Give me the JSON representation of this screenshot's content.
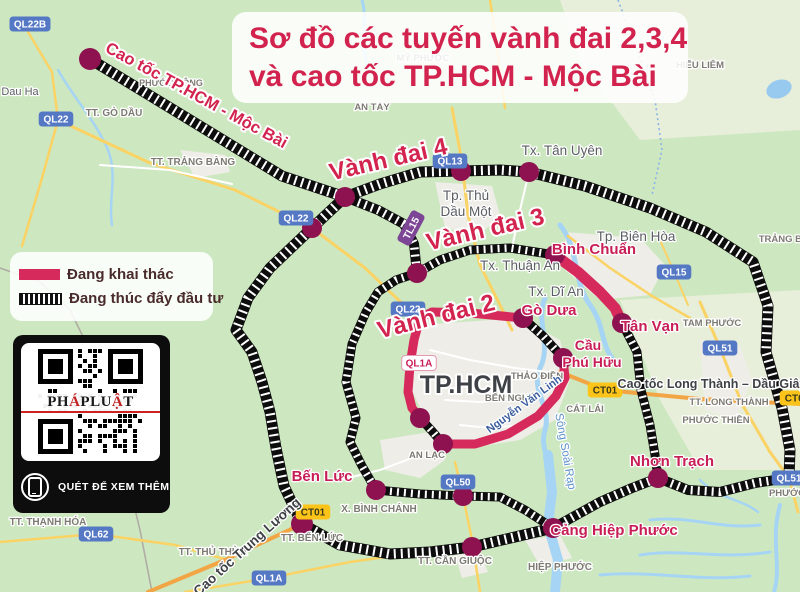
{
  "title": {
    "line1": "Sơ đồ các tuyến vành đai 2,3,4",
    "line2": "và cao tốc TP.HCM - Mộc Bài"
  },
  "legend": {
    "items": [
      {
        "label": "Đang khai thác",
        "type": "solid"
      },
      {
        "label": "Đang thúc đẩy đầu tư",
        "type": "striped"
      }
    ]
  },
  "qr": {
    "brand_parts": [
      {
        "t": "PH",
        "c": "#1a1a1a"
      },
      {
        "t": "Á",
        "c": "#c22222"
      },
      {
        "t": "PLU",
        "c": "#1a1a1a"
      },
      {
        "t": "Ậ",
        "c": "#c22222"
      },
      {
        "t": "T",
        "c": "#1a1a1a"
      }
    ],
    "caption": "QUÉT ĐỂ XEM THÊM"
  },
  "map": {
    "colors": {
      "bg": "#cde8c0",
      "urban": "#eeede7",
      "pale": "#e7eeda",
      "water": "#98c9ef",
      "river": "#a6d4f4",
      "road_yellow": "#fbd264",
      "road_orange": "#f2a544",
      "road_white": "#ffffff",
      "dash_black": "#0d0d0d",
      "pink_route": "#d62a5c",
      "dot": "#8e1150",
      "shield_blue": "#5578c4",
      "shield_yellow": "#fcc419",
      "shield_purple": "#7d4596",
      "gray": "#7c7a72",
      "city": "#5b5e63",
      "dark": "#3e4145",
      "pinklabel": "#c81e56",
      "bigpink": "#d2244e",
      "waterlabel": "#5e92cc",
      "roadblue": "#3d5e9e",
      "boundary": "#b0aca4",
      "boundary_blue": "#8ab4e8"
    },
    "urban": [
      {
        "d": "M420,325 L520,318 L560,340 L570,380 L555,420 L520,440 L470,448 L430,430 L412,390 L410,350 Z"
      },
      {
        "d": "M565,232 L640,238 L665,265 L650,295 L600,300 L565,270 Z"
      },
      {
        "d": "M435,182 L492,186 L500,215 L480,235 L445,228 Z"
      },
      {
        "d": "M380,440 L430,432 L445,460 L420,478 L385,470 Z"
      },
      {
        "d": "M700,340 L740,345 L752,380 L735,420 L705,410 Z"
      },
      {
        "d": "M180,150 L225,155 L230,172 L195,178 Z"
      },
      {
        "d": "M455,555 L480,552 L488,572 L462,578 Z"
      },
      {
        "d": "M525,540 L560,535 L572,558 L540,566 Z"
      }
    ],
    "pale": [
      {
        "d": "M560,0 L800,0 L800,130 L640,140 L580,60 Z"
      },
      {
        "d": "M620,300 L800,290 L800,470 L700,470 L660,400 Z"
      }
    ],
    "boundaries": [
      {
        "d": "M0,268 L40,282 L70,310 L92,355 L112,420 L128,480 L140,530 L152,592",
        "style": "land"
      },
      {
        "d": "M618,0 L636,48 L655,100 L662,150 L652,195",
        "style": "admin"
      }
    ],
    "water_paths": [
      {
        "d": "M545,298 C535,320 552,345 540,368 C530,390 552,408 545,430 C538,452 558,470 552,492",
        "w": 5
      },
      {
        "d": "M560,225 C580,250 572,280 590,305 C605,325 600,345 615,362",
        "w": 5
      },
      {
        "d": "M548,455 L552,492 L548,525 L558,560 L555,592",
        "w": 10
      },
      {
        "d": "M650,520 C690,515 720,530 760,525",
        "w": 3
      },
      {
        "d": "M640,555 C680,548 720,560 770,552",
        "w": 3
      },
      {
        "d": "M600,575 C650,570 700,582 750,576",
        "w": 3
      },
      {
        "d": "M58,70 C75,100 95,120 108,150 C118,175 108,200 112,225",
        "w": 2.5
      },
      {
        "d": "M362,0 C368,20 360,45 368,70",
        "w": 3
      },
      {
        "d": "M780,505 C770,540 782,565 774,592",
        "w": 4
      },
      {
        "d": "M700,480 C720,500 740,498 758,512",
        "w": 2.5
      }
    ],
    "lake": {
      "cx": 779,
      "cy": 89,
      "rx": 13,
      "ry": 9,
      "rot": -20
    },
    "roads": [
      {
        "d": "M58,120 L150,163 L235,190 L312,228 L365,268 L408,309 L418,322",
        "c": "road_yellow",
        "w": 3
      },
      {
        "d": "M28,32 L52,72 L58,120 L42,178 L22,246",
        "c": "road_yellow",
        "w": 2.5
      },
      {
        "d": "M452,108 L462,162 L468,215 L480,265 L500,305 L512,330",
        "c": "road_yellow",
        "w": 3
      },
      {
        "d": "M700,302 L720,348 L742,404 L770,452 L789,478 L798,512",
        "c": "road_yellow",
        "w": 3
      },
      {
        "d": "M185,592 L269,578 L350,562 L420,552",
        "c": "road_yellow",
        "w": 2.5
      },
      {
        "d": "M455,462 L463,496 L472,540 L480,592",
        "c": "road_yellow",
        "w": 2.5
      },
      {
        "d": "M0,542 L96,534 L175,545 L235,562",
        "c": "road_yellow",
        "w": 2.5
      },
      {
        "d": "M568,236 L610,268 L652,296 L690,318",
        "c": "road_yellow",
        "w": 2.5
      },
      {
        "d": "M660,240 L674,272 L688,305",
        "c": "road_yellow",
        "w": 2
      },
      {
        "d": "M490,0 L498,55 L505,108",
        "c": "road_yellow",
        "w": 2.5
      },
      {
        "d": "M560,372 L605,390 L700,399 L800,404",
        "c": "road_orange",
        "w": 4
      },
      {
        "d": "M148,592 L225,560 L302,524",
        "c": "road_orange",
        "w": 4
      },
      {
        "d": "M430,350 L470,360 L515,368 L548,372",
        "c": "road_white",
        "w": 2
      },
      {
        "d": "M445,400 L480,402 L515,398",
        "c": "road_white",
        "w": 2
      },
      {
        "d": "M460,425 L490,428 L520,425",
        "c": "road_white",
        "w": 2
      },
      {
        "d": "M340,480 L380,470 L420,455",
        "c": "road_white",
        "w": 2
      },
      {
        "d": "M529,172 L520,210 L512,248",
        "c": "road_white",
        "w": 2
      },
      {
        "d": "M100,165 L170,170 L232,184",
        "c": "road_white",
        "w": 2
      }
    ],
    "routes_dashed": [
      {
        "name": "cao-toc-moc-bai",
        "d": "M90,59 L282,176 L345,197",
        "w": 11
      },
      {
        "name": "vanh-dai-4-west",
        "d": "M345,197 L312,228 L270,268 L248,298 L236,330 L252,352 L262,382 L270,412 L276,448 L284,486 L302,524",
        "w": 11
      },
      {
        "name": "vanh-dai-4-north-east",
        "d": "M345,197 L380,184 L420,172 L461,171 L500,170 L529,172 L585,186 L650,208 L706,232 L753,262 L768,306 L766,352 L782,408 L790,450 L789,478",
        "w": 11
      },
      {
        "name": "vanh-dai-4-south",
        "d": "M302,524 L340,545 L390,554 L430,552 L472,547 L515,537 L553,528",
        "w": 11
      },
      {
        "name": "hiep-phuoc-nhon-trach",
        "d": "M553,528 L600,502 L632,488 L658,478",
        "w": 10
      },
      {
        "name": "nhon-trach-ql51",
        "d": "M658,478 L688,490 L720,492 L755,483 L789,478",
        "w": 10
      },
      {
        "name": "moc-bai-noi-dai",
        "d": "M345,197 L378,210 L404,224 L414,244 L417,273",
        "w": 10
      },
      {
        "name": "vanh-dai-3-west",
        "d": "M417,273 L396,280 L378,292 L366,312 L352,344 L346,382 L356,418 L350,442 L362,466 L376,490",
        "w": 9
      },
      {
        "name": "vanh-dai-3-northwest",
        "d": "M555,255 L510,248 L470,250 L440,260 L417,273",
        "w": 9
      },
      {
        "name": "vanh-dai-3-south",
        "d": "M376,490 L420,494 L463,496 L500,497 L525,510 L553,528",
        "w": 9
      },
      {
        "name": "vanh-dai-3-east",
        "d": "M622,323 L637,352 L641,390 L650,425 L655,455 L658,478",
        "w": 9
      },
      {
        "name": "vanh-dai-2-gap-go-dua",
        "d": "M523,318 L543,336 L563,358",
        "w": 9
      },
      {
        "name": "vanh-dai-2-gap-an-lac",
        "d": "M420,418 L432,431 L443,444",
        "w": 9
      }
    ],
    "routes_pink": [
      {
        "name": "vanh-dai-2-top",
        "d": "M420,318 L432,312 L470,313 L523,318",
        "w": 9
      },
      {
        "name": "vanh-dai-2-west",
        "d": "M420,318 L414,340 L410,365 L408,392 L412,408 L420,418",
        "w": 9
      },
      {
        "name": "vanh-dai-2-nguyen-van-linh",
        "d": "M443,444 L475,444 L508,434 L538,416 L556,396 L565,378 L563,358",
        "w": 9
      },
      {
        "name": "binh-chuan-tan-van",
        "d": "M555,255 L578,272 L600,292 L615,308 L622,323",
        "w": 11
      }
    ],
    "dots": [
      {
        "x": 90,
        "y": 59,
        "r": 11
      },
      {
        "x": 345,
        "y": 197,
        "r": 10
      },
      {
        "x": 312,
        "y": 228,
        "r": 10
      },
      {
        "x": 461,
        "y": 171,
        "r": 10
      },
      {
        "x": 529,
        "y": 172,
        "r": 10
      },
      {
        "x": 417,
        "y": 273,
        "r": 10
      },
      {
        "x": 555,
        "y": 255,
        "r": 10
      },
      {
        "x": 523,
        "y": 318,
        "r": 10
      },
      {
        "x": 622,
        "y": 323,
        "r": 10
      },
      {
        "x": 563,
        "y": 358,
        "r": 10
      },
      {
        "x": 420,
        "y": 418,
        "r": 10
      },
      {
        "x": 443,
        "y": 444,
        "r": 10
      },
      {
        "x": 376,
        "y": 490,
        "r": 10
      },
      {
        "x": 463,
        "y": 496,
        "r": 10
      },
      {
        "x": 302,
        "y": 524,
        "r": 11
      },
      {
        "x": 472,
        "y": 547,
        "r": 10
      },
      {
        "x": 553,
        "y": 528,
        "r": 10
      },
      {
        "x": 658,
        "y": 478,
        "r": 10
      }
    ],
    "shields": [
      {
        "text": "QL22B",
        "x": 30,
        "y": 24,
        "type": "blue"
      },
      {
        "text": "QL22",
        "x": 56,
        "y": 119,
        "type": "blue"
      },
      {
        "text": "QL22",
        "x": 296,
        "y": 218,
        "type": "blue"
      },
      {
        "text": "QL22",
        "x": 408,
        "y": 309,
        "type": "blue"
      },
      {
        "text": "QL13",
        "x": 450,
        "y": 161,
        "type": "blue"
      },
      {
        "text": "QL15",
        "x": 674,
        "y": 272,
        "type": "blue"
      },
      {
        "text": "QL51",
        "x": 720,
        "y": 348,
        "type": "blue"
      },
      {
        "text": "QL51",
        "x": 789,
        "y": 478,
        "type": "blue"
      },
      {
        "text": "QL50",
        "x": 458,
        "y": 482,
        "type": "blue"
      },
      {
        "text": "QL62",
        "x": 96,
        "y": 534,
        "type": "blue"
      },
      {
        "text": "QL1A",
        "x": 269,
        "y": 578,
        "type": "blue"
      },
      {
        "text": "QL1A",
        "x": 419,
        "y": 363,
        "type": "whitepink"
      },
      {
        "text": "CT01",
        "x": 313,
        "y": 512,
        "type": "yellow"
      },
      {
        "text": "CT01",
        "x": 605,
        "y": 390,
        "type": "yellow"
      },
      {
        "text": "CT01",
        "x": 797,
        "y": 398,
        "type": "yellow"
      },
      {
        "text": "TL15",
        "x": 411,
        "y": 228,
        "type": "purple",
        "rot": -62
      }
    ],
    "labels": [
      {
        "text": "Dau Ha",
        "x": 20,
        "y": 95,
        "s": 11,
        "c": "city",
        "w": 400
      },
      {
        "text": "PHƯỚC ĐÔNG",
        "x": 171,
        "y": 86,
        "s": 9,
        "c": "gray",
        "w": 700
      },
      {
        "text": "TT. TRẢNG BÀNG",
        "x": 193,
        "y": 165,
        "s": 10,
        "c": "gray",
        "w": 700
      },
      {
        "text": "TT. GÒ DẦU",
        "x": 114,
        "y": 116,
        "s": 10,
        "c": "gray",
        "w": 700
      },
      {
        "text": "AN TÂY",
        "x": 372,
        "y": 110,
        "s": 9.5,
        "c": "gray",
        "w": 700
      },
      {
        "text": "MỸ PHƯỚC",
        "x": 423,
        "y": 61,
        "s": 9.5,
        "c": "gray",
        "w": 700
      },
      {
        "text": "Tp. Thủ",
        "x": 466,
        "y": 200,
        "s": 13.5,
        "c": "city",
        "w": 400
      },
      {
        "text": "Dầu Một",
        "x": 466,
        "y": 216,
        "s": 13.5,
        "c": "city",
        "w": 400
      },
      {
        "text": "Tx. Tân Uyên",
        "x": 562,
        "y": 155,
        "s": 13.5,
        "c": "city",
        "w": 400
      },
      {
        "text": "HIẾU LIÊM",
        "x": 700,
        "y": 68,
        "s": 9.5,
        "c": "gray",
        "w": 700
      },
      {
        "text": "Tp. Biên Hòa",
        "x": 636,
        "y": 241,
        "s": 13.5,
        "c": "city",
        "w": 400
      },
      {
        "text": "TRẢNG BOM",
        "x": 788,
        "y": 242,
        "s": 9.5,
        "c": "gray",
        "w": 700
      },
      {
        "text": "Tx. Thuận An",
        "x": 520,
        "y": 270,
        "s": 13.5,
        "c": "city",
        "w": 400
      },
      {
        "text": "Tx. Dĩ An",
        "x": 556,
        "y": 296,
        "s": 13.5,
        "c": "city",
        "w": 400
      },
      {
        "text": "TAM PHƯỚC",
        "x": 712,
        "y": 326,
        "s": 9.5,
        "c": "gray",
        "w": 700
      },
      {
        "text": "Cao tốc Long Thành – Dầu Giây",
        "x": 712,
        "y": 388,
        "s": 12.5,
        "c": "dark",
        "w": 700
      },
      {
        "text": "TT. LONG THÀNH",
        "x": 729,
        "y": 405,
        "s": 9.5,
        "c": "gray",
        "w": 700
      },
      {
        "text": "PHƯỚC THIỀN",
        "x": 716,
        "y": 423,
        "s": 9.5,
        "c": "gray",
        "w": 700
      },
      {
        "text": "PHƯỚC AN",
        "x": 795,
        "y": 496,
        "s": 9.5,
        "c": "gray",
        "w": 700
      },
      {
        "text": "TP.HCM",
        "x": 466,
        "y": 393,
        "s": 25,
        "c": "dark",
        "w": 800
      },
      {
        "text": "THẢO ĐIỀN",
        "x": 537,
        "y": 379,
        "s": 9.5,
        "c": "gray",
        "w": 700
      },
      {
        "text": "BẾN NGHÉ",
        "x": 510,
        "y": 401,
        "s": 9.5,
        "c": "gray",
        "w": 700
      },
      {
        "text": "CÁT LÁI",
        "x": 585,
        "y": 412,
        "s": 9.5,
        "c": "gray",
        "w": 700
      },
      {
        "text": "AN LẠC",
        "x": 427,
        "y": 458,
        "s": 9.5,
        "c": "gray",
        "w": 700
      },
      {
        "text": "X. BÌNH CHÁNH",
        "x": 379,
        "y": 512,
        "s": 10,
        "c": "gray",
        "w": 700
      },
      {
        "text": "TT. BẾN LỨC",
        "x": 312,
        "y": 541,
        "s": 10,
        "c": "gray",
        "w": 700
      },
      {
        "text": "TT. THẠNH HÓA",
        "x": 48,
        "y": 525,
        "s": 10,
        "c": "gray",
        "w": 700
      },
      {
        "text": "TT. THỦ THỪA",
        "x": 213,
        "y": 555,
        "s": 10,
        "c": "gray",
        "w": 700
      },
      {
        "text": "TT. CẦN GIUỘC",
        "x": 455,
        "y": 564,
        "s": 10,
        "c": "gray",
        "w": 700
      },
      {
        "text": "HIỆP PHƯỚC",
        "x": 560,
        "y": 570,
        "s": 10,
        "c": "gray",
        "w": 700
      },
      {
        "text": "Sông Soài Rạp",
        "x": 562,
        "y": 452,
        "s": 11.5,
        "c": "waterlabel",
        "w": 400,
        "rot": 80
      },
      {
        "text": "Nguyễn Văn Linh",
        "x": 526,
        "y": 407,
        "s": 11,
        "c": "roadblue",
        "w": 700,
        "rot": -36
      },
      {
        "text": "Cao tốc Trung Lương",
        "x": 250,
        "y": 550,
        "s": 13.5,
        "c": "dark",
        "w": 700,
        "rot": -42
      },
      {
        "text": "Bình Chuẩn",
        "x": 594,
        "y": 254,
        "s": 15,
        "c": "pinklabel",
        "w": 700
      },
      {
        "text": "Gò Dưa",
        "x": 549,
        "y": 315,
        "s": 15,
        "c": "pinklabel",
        "w": 700
      },
      {
        "text": "Tân Vạn",
        "x": 650,
        "y": 331,
        "s": 15,
        "c": "pinklabel",
        "w": 700
      },
      {
        "text": "Cầu",
        "x": 588,
        "y": 350,
        "s": 14,
        "c": "pinklabel",
        "w": 700
      },
      {
        "text": "Phú Hữu",
        "x": 592,
        "y": 367,
        "s": 14,
        "c": "pinklabel",
        "w": 700
      },
      {
        "text": "Nhơn Trạch",
        "x": 672,
        "y": 466,
        "s": 15,
        "c": "pinklabel",
        "w": 700
      },
      {
        "text": "Bến Lức",
        "x": 322,
        "y": 481,
        "s": 15,
        "c": "pinklabel",
        "w": 700
      },
      {
        "text": "Cảng Hiệp Phước",
        "x": 614,
        "y": 535,
        "s": 15,
        "c": "pinklabel",
        "w": 700
      },
      {
        "text": "Vành đai 4",
        "x": 390,
        "y": 167,
        "s": 24,
        "c": "bigpink",
        "w": 800,
        "rot": -13
      },
      {
        "text": "Vành đai 3",
        "x": 487,
        "y": 237,
        "s": 24,
        "c": "bigpink",
        "w": 800,
        "rot": -13
      },
      {
        "text": "Vành đai 2",
        "x": 438,
        "y": 324,
        "s": 24,
        "c": "bigpink",
        "w": 800,
        "rot": -14
      },
      {
        "text": "Cao tốc TP.HCM - Mộc Bài",
        "x": 194,
        "y": 100,
        "s": 16.5,
        "c": "bigpink",
        "w": 800,
        "rot": 28.5
      }
    ]
  }
}
